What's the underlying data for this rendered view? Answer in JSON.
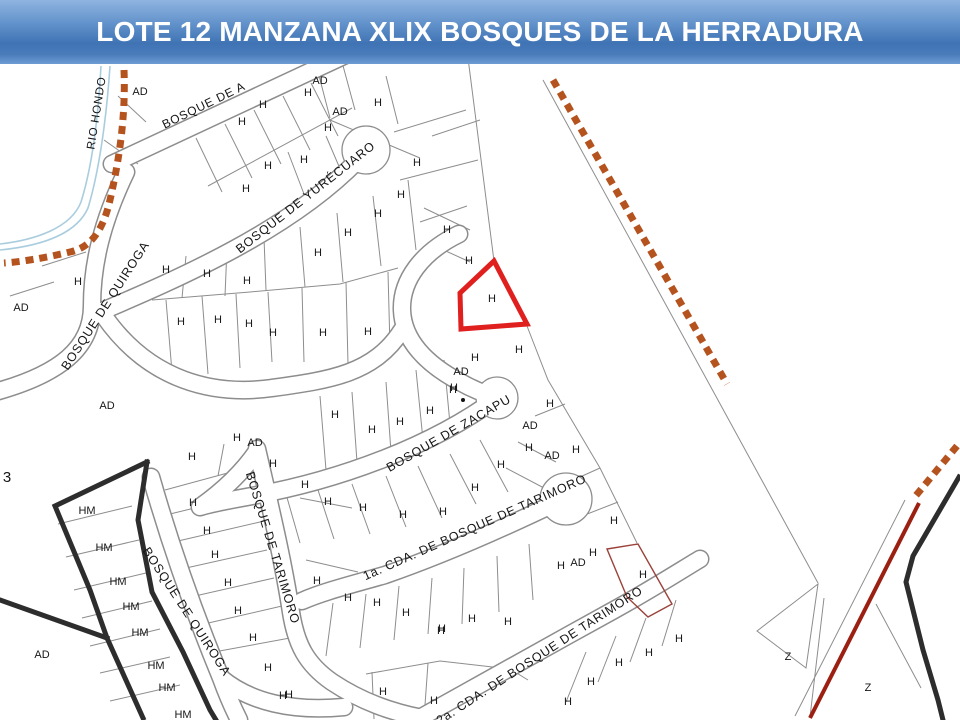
{
  "slide": {
    "title": "LOTE 12 MANZANA XLIX BOSQUES DE LA HERRADURA",
    "banner_color_top": "#8fb4e0",
    "banner_color_mid": "#3f73b4",
    "banner_color_bottom": "#6e9cd4",
    "title_text_color": "#ffffff"
  },
  "map": {
    "background_color": "#ffffff",
    "lot_line_color": "#8d8d8d",
    "boundary_black_color": "#2d2d2d",
    "boundary_dash_color": "#b5531f",
    "river_color": "#a9cdde",
    "highlight_lot_color": "#e01f1f",
    "secondary_lot_outline_color": "#9a423a",
    "diagonal_red_line_color": "#9c2012",
    "street_labels": [
      {
        "t": "RIO HONDO",
        "x": 97,
        "y": 113,
        "r": -81,
        "s": 11.5
      },
      {
        "t": "BOSQUE DE A",
        "x": 204,
        "y": 106,
        "r": -26,
        "s": 12
      },
      {
        "t": "BOSQUE DE YURÉCUARO",
        "x": 306,
        "y": 198,
        "r": -38,
        "s": 12.5
      },
      {
        "t": "BOSQUE DE QUIROGA",
        "x": 106,
        "y": 306,
        "r": -57,
        "s": 12.5
      },
      {
        "t": "BOSQUE DE ZACAPU",
        "x": 449,
        "y": 434,
        "r": -30,
        "s": 12.5
      },
      {
        "t": "1a. CDA. DE  BOSQUE DE TARIMORO",
        "x": 475,
        "y": 528,
        "r": -24,
        "s": 12.5
      },
      {
        "t": "BOSQUE DE TARIMORO",
        "x": 272,
        "y": 548,
        "r": 73,
        "s": 12.5
      },
      {
        "t": "BOSQUE DE QUIROGA",
        "x": 186,
        "y": 612,
        "r": 57,
        "s": 12.5
      },
      {
        "t": "2a. CDA. DE BOSQUE DE TARIMORO",
        "x": 540,
        "y": 656,
        "r": -33,
        "s": 12.5
      }
    ],
    "lot_markers": [
      {
        "t": "H",
        "x": 263,
        "y": 105
      },
      {
        "t": "H",
        "x": 242,
        "y": 122
      },
      {
        "t": "H",
        "x": 308,
        "y": 93
      },
      {
        "t": "H",
        "x": 328,
        "y": 128
      },
      {
        "t": "H",
        "x": 378,
        "y": 103
      },
      {
        "t": "H",
        "x": 417,
        "y": 163
      },
      {
        "t": "H",
        "x": 268,
        "y": 166
      },
      {
        "t": "H",
        "x": 304,
        "y": 160
      },
      {
        "t": "H",
        "x": 246,
        "y": 189
      },
      {
        "t": "H",
        "x": 318,
        "y": 253
      },
      {
        "t": "H",
        "x": 348,
        "y": 233
      },
      {
        "t": "H",
        "x": 378,
        "y": 214
      },
      {
        "t": "H",
        "x": 401,
        "y": 195
      },
      {
        "t": "H",
        "x": 447,
        "y": 230
      },
      {
        "t": "H",
        "x": 469,
        "y": 261
      },
      {
        "t": "H",
        "x": 78,
        "y": 282
      },
      {
        "t": "H",
        "x": 166,
        "y": 270
      },
      {
        "t": "H",
        "x": 207,
        "y": 274
      },
      {
        "t": "H",
        "x": 247,
        "y": 281
      },
      {
        "t": "H",
        "x": 181,
        "y": 322
      },
      {
        "t": "H",
        "x": 218,
        "y": 320
      },
      {
        "t": "H",
        "x": 249,
        "y": 324
      },
      {
        "t": "H",
        "x": 273,
        "y": 333
      },
      {
        "t": "H",
        "x": 323,
        "y": 333
      },
      {
        "t": "H",
        "x": 368,
        "y": 332
      },
      {
        "t": "H",
        "x": 335,
        "y": 415
      },
      {
        "t": "H",
        "x": 372,
        "y": 430
      },
      {
        "t": "H",
        "x": 400,
        "y": 422
      },
      {
        "t": "H",
        "x": 430,
        "y": 411
      },
      {
        "t": "H",
        "x": 453,
        "y": 390
      },
      {
        "t": "H",
        "x": 492,
        "y": 299
      },
      {
        "t": "H",
        "x": 519,
        "y": 350
      },
      {
        "t": "H",
        "x": 475,
        "y": 358
      },
      {
        "t": "H",
        "x": 454,
        "y": 388
      },
      {
        "t": "H",
        "x": 550,
        "y": 404
      },
      {
        "t": "H",
        "x": 576,
        "y": 450
      },
      {
        "t": "H",
        "x": 529,
        "y": 448
      },
      {
        "t": "H",
        "x": 501,
        "y": 465
      },
      {
        "t": "H",
        "x": 475,
        "y": 488
      },
      {
        "t": "H",
        "x": 443,
        "y": 512
      },
      {
        "t": "H",
        "x": 403,
        "y": 515
      },
      {
        "t": "H",
        "x": 363,
        "y": 508
      },
      {
        "t": "H",
        "x": 328,
        "y": 502
      },
      {
        "t": "H",
        "x": 305,
        "y": 485
      },
      {
        "t": "H",
        "x": 614,
        "y": 521
      },
      {
        "t": "H",
        "x": 593,
        "y": 553
      },
      {
        "t": "H",
        "x": 561,
        "y": 566
      },
      {
        "t": "H",
        "x": 643,
        "y": 575
      },
      {
        "t": "H",
        "x": 679,
        "y": 639
      },
      {
        "t": "H",
        "x": 649,
        "y": 653
      },
      {
        "t": "H",
        "x": 619,
        "y": 663
      },
      {
        "t": "H",
        "x": 591,
        "y": 682
      },
      {
        "t": "H",
        "x": 568,
        "y": 702
      },
      {
        "t": "H",
        "x": 317,
        "y": 581
      },
      {
        "t": "H",
        "x": 348,
        "y": 598
      },
      {
        "t": "H",
        "x": 377,
        "y": 603
      },
      {
        "t": "H",
        "x": 406,
        "y": 613
      },
      {
        "t": "H",
        "x": 442,
        "y": 629
      },
      {
        "t": "H",
        "x": 472,
        "y": 619
      },
      {
        "t": "H",
        "x": 508,
        "y": 622
      },
      {
        "t": "H",
        "x": 441,
        "y": 631
      },
      {
        "t": "H",
        "x": 283,
        "y": 696
      },
      {
        "t": "H",
        "x": 383,
        "y": 692
      },
      {
        "t": "H",
        "x": 434,
        "y": 701
      },
      {
        "t": "H",
        "x": 253,
        "y": 638
      },
      {
        "t": "H",
        "x": 268,
        "y": 668
      },
      {
        "t": "H",
        "x": 289,
        "y": 695
      },
      {
        "t": "H",
        "x": 192,
        "y": 457
      },
      {
        "t": "H",
        "x": 237,
        "y": 438
      },
      {
        "t": "H",
        "x": 273,
        "y": 464
      },
      {
        "t": "H",
        "x": 193,
        "y": 503
      },
      {
        "t": "H",
        "x": 207,
        "y": 531
      },
      {
        "t": "H",
        "x": 215,
        "y": 555
      },
      {
        "t": "H",
        "x": 228,
        "y": 583
      },
      {
        "t": "H",
        "x": 238,
        "y": 611
      },
      {
        "t": "AD",
        "x": 140,
        "y": 92
      },
      {
        "t": "AD",
        "x": 320,
        "y": 81
      },
      {
        "t": "AD",
        "x": 340,
        "y": 112
      },
      {
        "t": "AD",
        "x": 21,
        "y": 308
      },
      {
        "t": "AD",
        "x": 107,
        "y": 406
      },
      {
        "t": "AD",
        "x": 255,
        "y": 443
      },
      {
        "t": "AD",
        "x": 461,
        "y": 372
      },
      {
        "t": "AD",
        "x": 530,
        "y": 426
      },
      {
        "t": "AD",
        "x": 552,
        "y": 456
      },
      {
        "t": "AD",
        "x": 578,
        "y": 563
      },
      {
        "t": "AD",
        "x": 42,
        "y": 655
      },
      {
        "t": "HM",
        "x": 87,
        "y": 511
      },
      {
        "t": "HM",
        "x": 104,
        "y": 548
      },
      {
        "t": "HM",
        "x": 118,
        "y": 582
      },
      {
        "t": "HM",
        "x": 131,
        "y": 607
      },
      {
        "t": "HM",
        "x": 140,
        "y": 633
      },
      {
        "t": "HM",
        "x": 156,
        "y": 666
      },
      {
        "t": "HM",
        "x": 167,
        "y": 688
      },
      {
        "t": "HM",
        "x": 183,
        "y": 715
      },
      {
        "t": "Z",
        "x": 788,
        "y": 657
      },
      {
        "t": "Z",
        "x": 868,
        "y": 688
      },
      {
        "t": "3",
        "x": 7,
        "y": 478,
        "s": 15
      }
    ]
  }
}
